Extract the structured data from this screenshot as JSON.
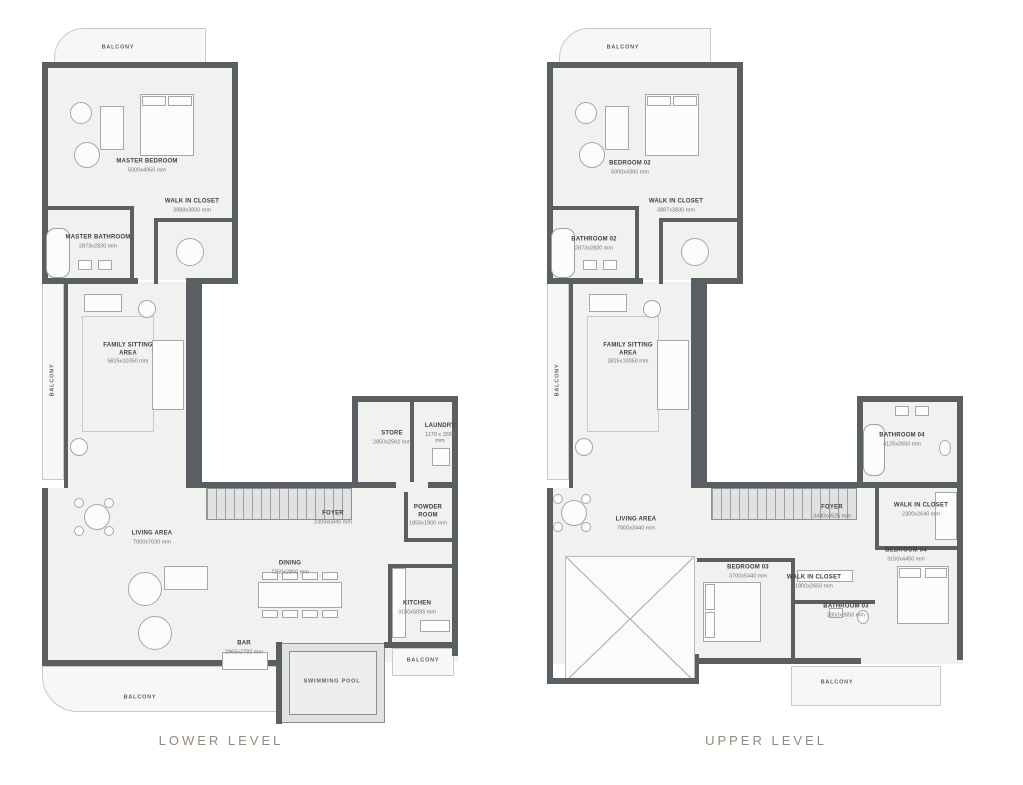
{
  "colors": {
    "accent": "#97897a",
    "wall": "#5a5f63",
    "floor": "#f1f1ef"
  },
  "plans": [
    {
      "label": "LOWER LEVEL",
      "rooms": {
        "balcony_top": {
          "name": "BALCONY"
        },
        "master_bedroom": {
          "name": "MASTER BEDROOM",
          "dims": "5000x4950 mm"
        },
        "walk_in_closet": {
          "name": "WALK IN CLOSET",
          "dims": "3988x3830 mm"
        },
        "master_bathroom": {
          "name": "MASTER BATHROOM",
          "dims": "2873x2830 mm"
        },
        "balcony_left": {
          "name": "BALCONY"
        },
        "family_sitting": {
          "name": "FAMILY SITTING AREA",
          "dims": "5825x10350 mm"
        },
        "store": {
          "name": "STORE",
          "dims": "2850x2592 mm"
        },
        "laundry": {
          "name": "LAUNDRY",
          "dims": "1170 x 2650 mm"
        },
        "foyer": {
          "name": "FOYER",
          "dims": "2300x5840 mm"
        },
        "powder_room": {
          "name": "POWDER ROOM",
          "dims": "1855x1900 mm"
        },
        "living_area": {
          "name": "LIVING AREA",
          "dims": "7000x7030 mm"
        },
        "dining": {
          "name": "DINING",
          "dims": "7250x2800 mm"
        },
        "kitchen": {
          "name": "KITCHEN",
          "dims": "3150x5095 mm"
        },
        "bar": {
          "name": "BAR",
          "dims": "2965x2782 mm"
        },
        "swimming_pool": {
          "name": "SWIMMING POOL"
        },
        "balcony_bottom": {
          "name": "BALCONY"
        },
        "balcony_right": {
          "name": "BALCONY"
        }
      }
    },
    {
      "label": "UPPER LEVEL",
      "rooms": {
        "balcony_top": {
          "name": "BALCONY"
        },
        "bedroom_02": {
          "name": "BEDROOM 02",
          "dims": "5000x4360 mm"
        },
        "walk_in_closet_02": {
          "name": "WALK IN CLOSET",
          "dims": "3887x3830 mm"
        },
        "bathroom_02": {
          "name": "BATHROOM 02",
          "dims": "2873x2830 mm"
        },
        "balcony_left": {
          "name": "BALCONY"
        },
        "family_sitting": {
          "name": "FAMILY SITTING AREA",
          "dims": "3825x10050 mm"
        },
        "bathroom_04": {
          "name": "BATHROOM 04",
          "dims": "4125x2650 mm"
        },
        "foyer": {
          "name": "FOYER",
          "dims": "3440x4525 mm"
        },
        "walk_in_closet_04": {
          "name": "WALK IN CLOSET",
          "dims": "2300x2640 mm"
        },
        "bedroom_04": {
          "name": "BEDROOM 04",
          "dims": "3150x4450 mm"
        },
        "living_area": {
          "name": "LIVING AREA",
          "dims": "7000x3440 mm"
        },
        "bedroom_03": {
          "name": "BEDROOM 03",
          "dims": "3700x5440 mm"
        },
        "walk_in_closet_03": {
          "name": "WALK IN CLOSET",
          "dims": "1800x2650 mm"
        },
        "bathroom_03": {
          "name": "BATHROOM 03",
          "dims": "2850x2650 mm"
        },
        "balcony_bottom": {
          "name": "BALCONY"
        }
      }
    }
  ]
}
